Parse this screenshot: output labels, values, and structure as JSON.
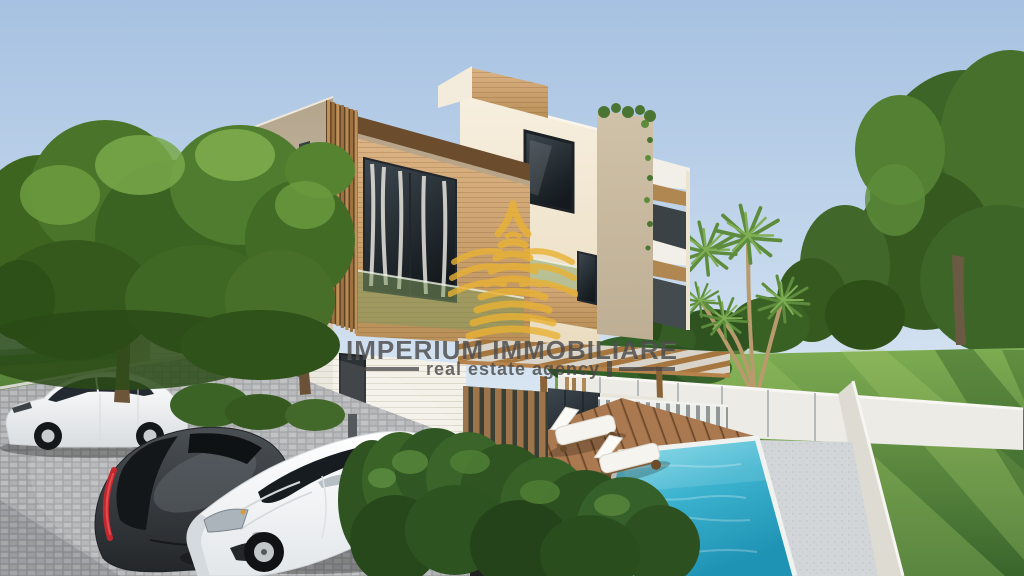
{
  "watermark": {
    "title": "IMPERIUM IMMOBILIARE",
    "subtitle": "real estate agency",
    "text_color": "#464646",
    "logo_color": "#e9b235",
    "logo_icon": "building-logo-icon"
  },
  "scene": {
    "type": "architectural-exterior-render",
    "elements": [
      "modern three-storey villa with wood cladding",
      "cobblestone driveway with three parked cars",
      "swimming pool with white coping",
      "two sun loungers on wood deck",
      "wood slat pergola and privacy screens",
      "white garden perimeter wall",
      "lawns, hedges, palm and leafy trees"
    ],
    "colors": {
      "sky_top": "#a6c1e1",
      "sky_horizon": "#dfeaf3",
      "facade_cream": "#f2e9d6",
      "facade_beige": "#c3b59d",
      "wood_cladding": "#cda671",
      "wood_dark": "#7b5836",
      "pool_water": "#3cb3cf",
      "lawn_green": "#5d8f3f",
      "paving_gray": "#b4b5b7",
      "garden_wall_white": "#ebe9e2",
      "car_white": "#f5f6f7",
      "car_dark": "#33373a",
      "tail_light_red": "#c0282f"
    }
  }
}
